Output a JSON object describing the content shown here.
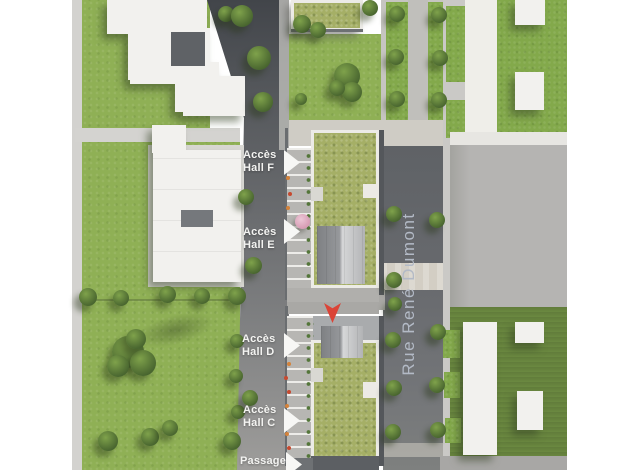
{
  "scene": {
    "description": "Aerial 3D site plan of a residential development",
    "street": {
      "name": "Rue René Dumont"
    },
    "access_points": [
      {
        "id": "hall-f",
        "label": "Accès\nHall F"
      },
      {
        "id": "hall-e",
        "label": "Accès\nHall E"
      },
      {
        "id": "hall-d",
        "label": "Accès\nHall D"
      },
      {
        "id": "hall-c",
        "label": "Accès\nHall C"
      },
      {
        "id": "passage",
        "label": "Passage"
      }
    ],
    "icons": {
      "access_arrow": "white-right-arrow",
      "marker": "red-location-pointer"
    },
    "colors": {
      "grass": "#8fb055",
      "green_roof": "#a5af66",
      "road_dark": "#46494d",
      "asphalt": "#65686c",
      "road_light": "#9d9c9a",
      "building_white": "#f2f1ee",
      "plaza_gray": "#b5b4b2",
      "crossing_beige": "#d3cec4",
      "label_text": "#f3f3f1",
      "street_text": "#b5bcc8",
      "marker_red": "#db4437",
      "background": "#ffffff"
    }
  }
}
